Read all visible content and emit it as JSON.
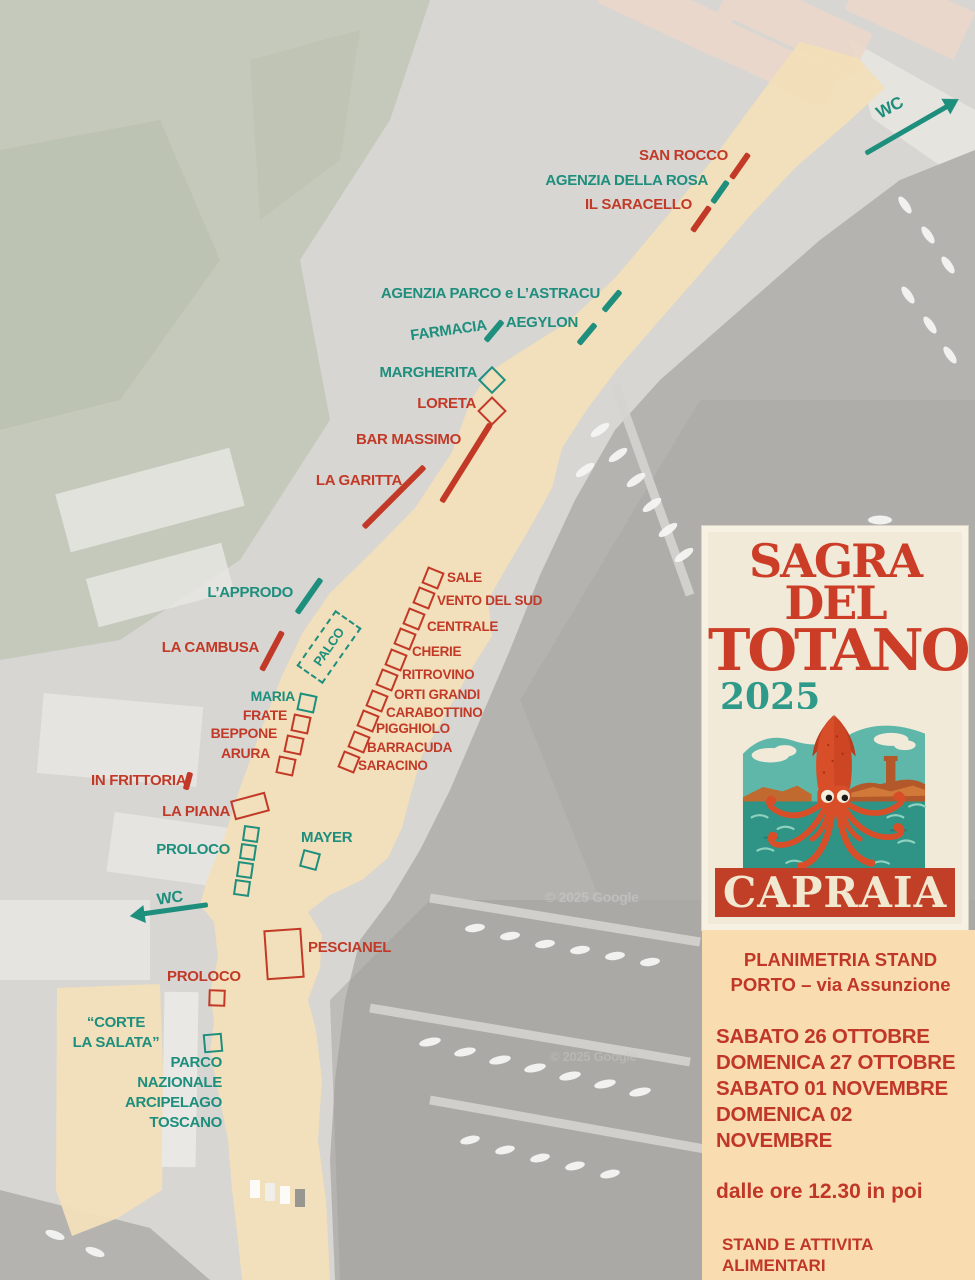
{
  "map": {
    "colors": {
      "red": "#c23a27",
      "teal": "#1e8e7d",
      "watermark": "#c6c5c2",
      "path_beige": "#f2dfb9"
    },
    "labels": [
      {
        "name": "san-rocco-label",
        "text": "SAN ROCCO",
        "x": 728,
        "y": 148,
        "color": "red",
        "align": "right",
        "size": 15
      },
      {
        "name": "agenzia-della-rosa-label",
        "text": "AGENZIA DELLA ROSA",
        "x": 708,
        "y": 173,
        "color": "teal",
        "align": "right",
        "size": 15
      },
      {
        "name": "il-saracello-label",
        "text": "IL SARACELLO",
        "x": 692,
        "y": 197,
        "color": "red",
        "align": "right",
        "size": 15
      },
      {
        "name": "agenzia-parco-label",
        "text": "AGENZIA PARCO e L’ASTRACU",
        "x": 600,
        "y": 286,
        "color": "teal",
        "align": "right",
        "size": 15
      },
      {
        "name": "aegylon-label",
        "text": "AEGYLON",
        "x": 578,
        "y": 315,
        "color": "teal",
        "align": "right",
        "size": 15
      },
      {
        "name": "farmacia-label",
        "text": "FARMACIA",
        "x": 487,
        "y": 323,
        "color": "teal",
        "align": "right",
        "size": 15,
        "rotate": -8
      },
      {
        "name": "margherita-label",
        "text": "MARGHERITA",
        "x": 477,
        "y": 365,
        "color": "teal",
        "align": "right",
        "size": 15
      },
      {
        "name": "loreta-label",
        "text": "LORETA",
        "x": 476,
        "y": 396,
        "color": "red",
        "align": "right",
        "size": 15
      },
      {
        "name": "bar-massimo-label",
        "text": "BAR MASSIMO",
        "x": 461,
        "y": 432,
        "color": "red",
        "align": "right",
        "size": 15
      },
      {
        "name": "la-garitta-label",
        "text": "LA GARITTA",
        "x": 402,
        "y": 473,
        "color": "red",
        "align": "right",
        "size": 15
      },
      {
        "name": "l-approdo-label",
        "text": "L’APPRODO",
        "x": 293,
        "y": 585,
        "color": "teal",
        "align": "right",
        "size": 15
      },
      {
        "name": "la-cambusa-label",
        "text": "LA CAMBUSA",
        "x": 259,
        "y": 640,
        "color": "red",
        "align": "right",
        "size": 15
      },
      {
        "name": "palco-label",
        "text": "PALCO",
        "x": 329,
        "y": 647,
        "color": "teal",
        "align": "center",
        "size": 13,
        "rotate": -55
      },
      {
        "name": "sale-label",
        "text": "SALE",
        "x": 447,
        "y": 571,
        "color": "red",
        "align": "left",
        "size": 13.5
      },
      {
        "name": "vento-del-sud-label",
        "text": "VENTO DEL SUD",
        "x": 437,
        "y": 594,
        "color": "red",
        "align": "left",
        "size": 13.5
      },
      {
        "name": "centrale-label",
        "text": "CENTRALE",
        "x": 427,
        "y": 620,
        "color": "red",
        "align": "left",
        "size": 13.5
      },
      {
        "name": "cherie-label",
        "text": "CHERIE",
        "x": 412,
        "y": 645,
        "color": "red",
        "align": "left",
        "size": 13.5
      },
      {
        "name": "ritrovino-label",
        "text": "RITROVINO",
        "x": 402,
        "y": 668,
        "color": "red",
        "align": "left",
        "size": 13.5
      },
      {
        "name": "orti-grandi-label",
        "text": "ORTI GRANDI",
        "x": 394,
        "y": 688,
        "color": "red",
        "align": "left",
        "size": 13.5
      },
      {
        "name": "carabottino-label",
        "text": "CARABOTTINO",
        "x": 386,
        "y": 706,
        "color": "red",
        "align": "left",
        "size": 13.5
      },
      {
        "name": "pigghiolo-label",
        "text": "PIGGHIOLO",
        "x": 376,
        "y": 722,
        "color": "red",
        "align": "left",
        "size": 13.5
      },
      {
        "name": "barracuda-label",
        "text": "BARRACUDA",
        "x": 367,
        "y": 741,
        "color": "red",
        "align": "left",
        "size": 13.5
      },
      {
        "name": "saracino-label",
        "text": "SARACINO",
        "x": 358,
        "y": 759,
        "color": "red",
        "align": "left",
        "size": 13.5
      },
      {
        "name": "maria-label",
        "text": "MARIA",
        "x": 295,
        "y": 689,
        "color": "teal",
        "align": "right",
        "size": 14
      },
      {
        "name": "frate-label",
        "text": "FRATE",
        "x": 287,
        "y": 708,
        "color": "red",
        "align": "right",
        "size": 14
      },
      {
        "name": "beppone-label",
        "text": "BEPPONE",
        "x": 277,
        "y": 726,
        "color": "red",
        "align": "right",
        "size": 14
      },
      {
        "name": "arura-label",
        "text": "ARURA",
        "x": 270,
        "y": 746,
        "color": "red",
        "align": "right",
        "size": 14
      },
      {
        "name": "in-frittoria-label",
        "text": "IN FRITTORIA",
        "x": 91,
        "y": 773,
        "color": "red",
        "align": "left",
        "size": 15
      },
      {
        "name": "la-piana-label",
        "text": "LA PIANA",
        "x": 230,
        "y": 804,
        "color": "red",
        "align": "right",
        "size": 15
      },
      {
        "name": "proloco-north-label",
        "text": "PROLOCO",
        "x": 230,
        "y": 842,
        "color": "teal",
        "align": "right",
        "size": 15
      },
      {
        "name": "mayer-label",
        "text": "MAYER",
        "x": 301,
        "y": 830,
        "color": "teal",
        "align": "left",
        "size": 15
      },
      {
        "name": "wc-left-label",
        "text": "WC",
        "x": 157,
        "y": 891,
        "color": "teal",
        "align": "left",
        "size": 16,
        "rotate": -8
      },
      {
        "name": "wc-top-label",
        "text": "WC",
        "x": 876,
        "y": 99,
        "color": "teal",
        "align": "left",
        "size": 17,
        "rotate": -28
      },
      {
        "name": "pescianel-label",
        "text": "PESCIANEL",
        "x": 308,
        "y": 940,
        "color": "red",
        "align": "left",
        "size": 15
      },
      {
        "name": "proloco-south-label",
        "text": "PROLOCO",
        "x": 167,
        "y": 969,
        "color": "red",
        "align": "left",
        "size": 15
      },
      {
        "name": "corte-la-salata-label-line1",
        "text": "“CORTE",
        "x": 116,
        "y": 1023,
        "color": "teal",
        "align": "center",
        "size": 15
      },
      {
        "name": "corte-la-salata-label-line2",
        "text": "LA SALATA”",
        "x": 116,
        "y": 1043,
        "color": "teal",
        "align": "center",
        "size": 15
      },
      {
        "name": "parco-nazionale-label-line1",
        "text": "PARCO",
        "x": 222,
        "y": 1055,
        "color": "teal",
        "align": "right",
        "size": 15
      },
      {
        "name": "parco-nazionale-label-line2",
        "text": "NAZIONALE",
        "x": 222,
        "y": 1075,
        "color": "teal",
        "align": "right",
        "size": 15
      },
      {
        "name": "parco-nazionale-label-line3",
        "text": "ARCIPELAGO",
        "x": 222,
        "y": 1095,
        "color": "teal",
        "align": "right",
        "size": 15
      },
      {
        "name": "parco-nazionale-label-line4",
        "text": "TOSCANO",
        "x": 222,
        "y": 1115,
        "color": "teal",
        "align": "right",
        "size": 15
      },
      {
        "name": "google-watermark-1",
        "text": "© 2025 Google",
        "x": 545,
        "y": 890,
        "color": "watermark",
        "align": "left",
        "size": 14,
        "opacity": 0.75
      },
      {
        "name": "google-watermark-2",
        "text": "© 2025 Google",
        "x": 550,
        "y": 1050,
        "color": "watermark",
        "align": "left",
        "size": 13,
        "opacity": 0.5
      }
    ],
    "markers": [
      {
        "name": "san-rocco",
        "type": "dash",
        "x": 740,
        "y": 166,
        "w": 30,
        "h": 6,
        "rotate": -55,
        "color": "red"
      },
      {
        "name": "agenzia-della-rosa",
        "type": "dash",
        "x": 720,
        "y": 192,
        "w": 26,
        "h": 6,
        "rotate": -55,
        "color": "teal"
      },
      {
        "name": "il-saracello",
        "type": "dash",
        "x": 701,
        "y": 219,
        "w": 30,
        "h": 6,
        "rotate": -55,
        "color": "red"
      },
      {
        "name": "agenzia-parco",
        "type": "dash",
        "x": 612,
        "y": 301,
        "w": 26,
        "h": 6,
        "rotate": -50,
        "color": "teal"
      },
      {
        "name": "aegylon",
        "type": "dash",
        "x": 587,
        "y": 334,
        "w": 26,
        "h": 6,
        "rotate": -50,
        "color": "teal"
      },
      {
        "name": "farmacia",
        "type": "dash",
        "x": 494,
        "y": 331,
        "w": 26,
        "h": 6,
        "rotate": -50,
        "color": "teal"
      },
      {
        "name": "margherita",
        "type": "square",
        "x": 492,
        "y": 380,
        "w": 20,
        "h": 20,
        "rotate": 45,
        "color": "teal"
      },
      {
        "name": "loreta",
        "type": "square",
        "x": 492,
        "y": 411,
        "w": 21,
        "h": 21,
        "rotate": 45,
        "color": "red"
      },
      {
        "name": "bar-massimo",
        "type": "line",
        "x": 466,
        "y": 463,
        "w": 92,
        "h": 6,
        "rotate": -58,
        "color": "red"
      },
      {
        "name": "la-garitta",
        "type": "line",
        "x": 394,
        "y": 497,
        "w": 86,
        "h": 6,
        "rotate": -45,
        "color": "red"
      },
      {
        "name": "l-approdo",
        "type": "line",
        "x": 309,
        "y": 596,
        "w": 42,
        "h": 6,
        "rotate": -55,
        "color": "teal"
      },
      {
        "name": "la-cambusa",
        "type": "line",
        "x": 272,
        "y": 651,
        "w": 44,
        "h": 6,
        "rotate": -62,
        "color": "red"
      },
      {
        "name": "palco",
        "type": "dashed-rect",
        "x": 329,
        "y": 647,
        "w": 68,
        "h": 32,
        "rotate": -55,
        "color": "teal"
      },
      {
        "name": "sale-stand",
        "type": "square",
        "x": 433,
        "y": 578,
        "w": 18,
        "h": 18,
        "rotate": 22,
        "color": "red"
      },
      {
        "name": "vento-del-sud-stand",
        "type": "square",
        "x": 424,
        "y": 598,
        "w": 18,
        "h": 18,
        "rotate": 22,
        "color": "red"
      },
      {
        "name": "centrale-stand",
        "type": "square",
        "x": 414,
        "y": 619,
        "w": 18,
        "h": 18,
        "rotate": 22,
        "color": "red"
      },
      {
        "name": "cherie-stand",
        "type": "square",
        "x": 405,
        "y": 639,
        "w": 18,
        "h": 18,
        "rotate": 22,
        "color": "red"
      },
      {
        "name": "ritrovino-stand",
        "type": "square",
        "x": 396,
        "y": 660,
        "w": 18,
        "h": 18,
        "rotate": 22,
        "color": "red"
      },
      {
        "name": "orti-grandi-stand",
        "type": "square",
        "x": 387,
        "y": 680,
        "w": 18,
        "h": 18,
        "rotate": 22,
        "color": "red"
      },
      {
        "name": "carabottino-stand",
        "type": "square",
        "x": 377,
        "y": 701,
        "w": 18,
        "h": 18,
        "rotate": 22,
        "color": "red"
      },
      {
        "name": "pigghiolo-stand",
        "type": "square",
        "x": 368,
        "y": 721,
        "w": 18,
        "h": 18,
        "rotate": 22,
        "color": "red"
      },
      {
        "name": "barracuda-stand",
        "type": "square",
        "x": 359,
        "y": 742,
        "w": 18,
        "h": 18,
        "rotate": 22,
        "color": "red"
      },
      {
        "name": "saracino-stand",
        "type": "square",
        "x": 349,
        "y": 762,
        "w": 18,
        "h": 18,
        "rotate": 22,
        "color": "red"
      },
      {
        "name": "maria-stand",
        "type": "square",
        "x": 307,
        "y": 703,
        "w": 18,
        "h": 18,
        "rotate": 12,
        "color": "teal"
      },
      {
        "name": "frate-stand",
        "type": "square",
        "x": 301,
        "y": 724,
        "w": 18,
        "h": 18,
        "rotate": 12,
        "color": "red"
      },
      {
        "name": "beppone-stand",
        "type": "square",
        "x": 294,
        "y": 745,
        "w": 18,
        "h": 18,
        "rotate": 12,
        "color": "red"
      },
      {
        "name": "arura-stand",
        "type": "square",
        "x": 286,
        "y": 766,
        "w": 18,
        "h": 18,
        "rotate": 12,
        "color": "red"
      },
      {
        "name": "in-frittoria",
        "type": "dash",
        "x": 188,
        "y": 781,
        "w": 18,
        "h": 6,
        "rotate": -75,
        "color": "red"
      },
      {
        "name": "la-piana-stand",
        "type": "rect",
        "x": 250,
        "y": 806,
        "w": 36,
        "h": 20,
        "rotate": -15,
        "color": "red"
      },
      {
        "name": "proloco-north-stand-1",
        "type": "square",
        "x": 251,
        "y": 834,
        "w": 16,
        "h": 16,
        "rotate": 8,
        "color": "teal"
      },
      {
        "name": "proloco-north-stand-2",
        "type": "square",
        "x": 248,
        "y": 852,
        "w": 16,
        "h": 16,
        "rotate": 8,
        "color": "teal"
      },
      {
        "name": "proloco-north-stand-3",
        "type": "square",
        "x": 245,
        "y": 870,
        "w": 16,
        "h": 16,
        "rotate": 8,
        "color": "teal"
      },
      {
        "name": "proloco-north-stand-4",
        "type": "square",
        "x": 242,
        "y": 888,
        "w": 16,
        "h": 16,
        "rotate": 8,
        "color": "teal"
      },
      {
        "name": "mayer-stand",
        "type": "square",
        "x": 310,
        "y": 860,
        "w": 18,
        "h": 18,
        "rotate": 15,
        "color": "teal"
      },
      {
        "name": "pescianel-stand",
        "type": "rect",
        "x": 284,
        "y": 954,
        "w": 38,
        "h": 50,
        "rotate": -4,
        "color": "red"
      },
      {
        "name": "proloco-south-stand",
        "type": "square",
        "x": 217,
        "y": 998,
        "w": 17,
        "h": 17,
        "rotate": 2,
        "color": "red"
      },
      {
        "name": "parco-nazionale-stand",
        "type": "square",
        "x": 213,
        "y": 1043,
        "w": 19,
        "h": 19,
        "rotate": -5,
        "color": "teal"
      },
      {
        "name": "wc-top-arrow",
        "type": "arrow",
        "x": 912,
        "y": 129,
        "w": 105,
        "h": 5,
        "rotate": -30,
        "color": "teal"
      },
      {
        "name": "wc-left-arrow",
        "type": "arrow",
        "x": 170,
        "y": 908,
        "w": 76,
        "h": 5,
        "rotate": 172,
        "color": "teal"
      }
    ]
  },
  "poster": {
    "title_line1": "SAGRA DEL",
    "title_line2": "TOTANO",
    "year": "2025",
    "city": "CAPRAIA"
  },
  "panel": {
    "heading_line1": "PLANIMETRIA STAND",
    "heading_line2": "PORTO – via Assunzione",
    "dates": [
      "SABATO 26 OTTOBRE",
      "DOMENICA 27 OTTOBRE",
      "SABATO 01 NOVEMBRE",
      "DOMENICA 02 NOVEMBRE"
    ],
    "time_note": "dalle ore 12.30  in poi",
    "legend": [
      {
        "line1": "STAND E ATTIVITA",
        "line2": "ALIMENTARI",
        "color": "red"
      },
      {
        "line1": "STAND E ATTIVITA’",
        "line2": "NON ALIMENTARI",
        "color": "teal"
      }
    ]
  }
}
